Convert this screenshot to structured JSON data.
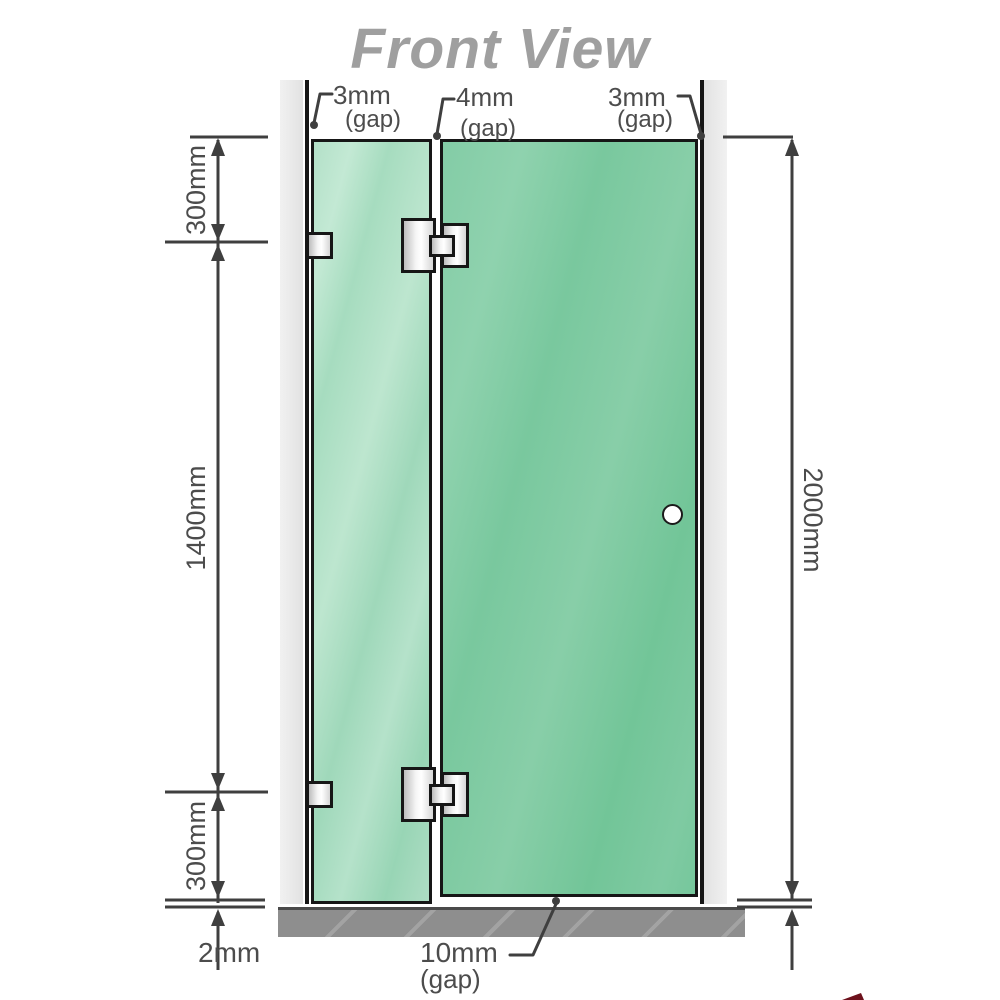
{
  "title": "Front View",
  "labels": {
    "gap_top_left": {
      "value": "3mm",
      "qualifier": "(gap)"
    },
    "gap_top_middle": {
      "value": "4mm",
      "qualifier": "(gap)"
    },
    "gap_top_right": {
      "value": "3mm",
      "qualifier": "(gap)"
    },
    "height_top": "300mm",
    "height_middle": "1400mm",
    "height_bottom": "300mm",
    "floor_clearance": "2mm",
    "total_height": "2000mm",
    "gap_bottom": {
      "value": "10mm",
      "qualifier": "(gap)"
    }
  },
  "colors": {
    "title_text": "#9f9f9f",
    "dimension_text": "#4c4c4c",
    "dimension_line": "#3f3f3f",
    "outline_black": "#161616",
    "glass_fixed_panel": "#a5dabe",
    "glass_door_panel": "#76c79c",
    "wall_profile_gray": "#e9e9e9",
    "hardware_metal": "#e8e8e8",
    "floor_gray": "#8e8e8e"
  }
}
